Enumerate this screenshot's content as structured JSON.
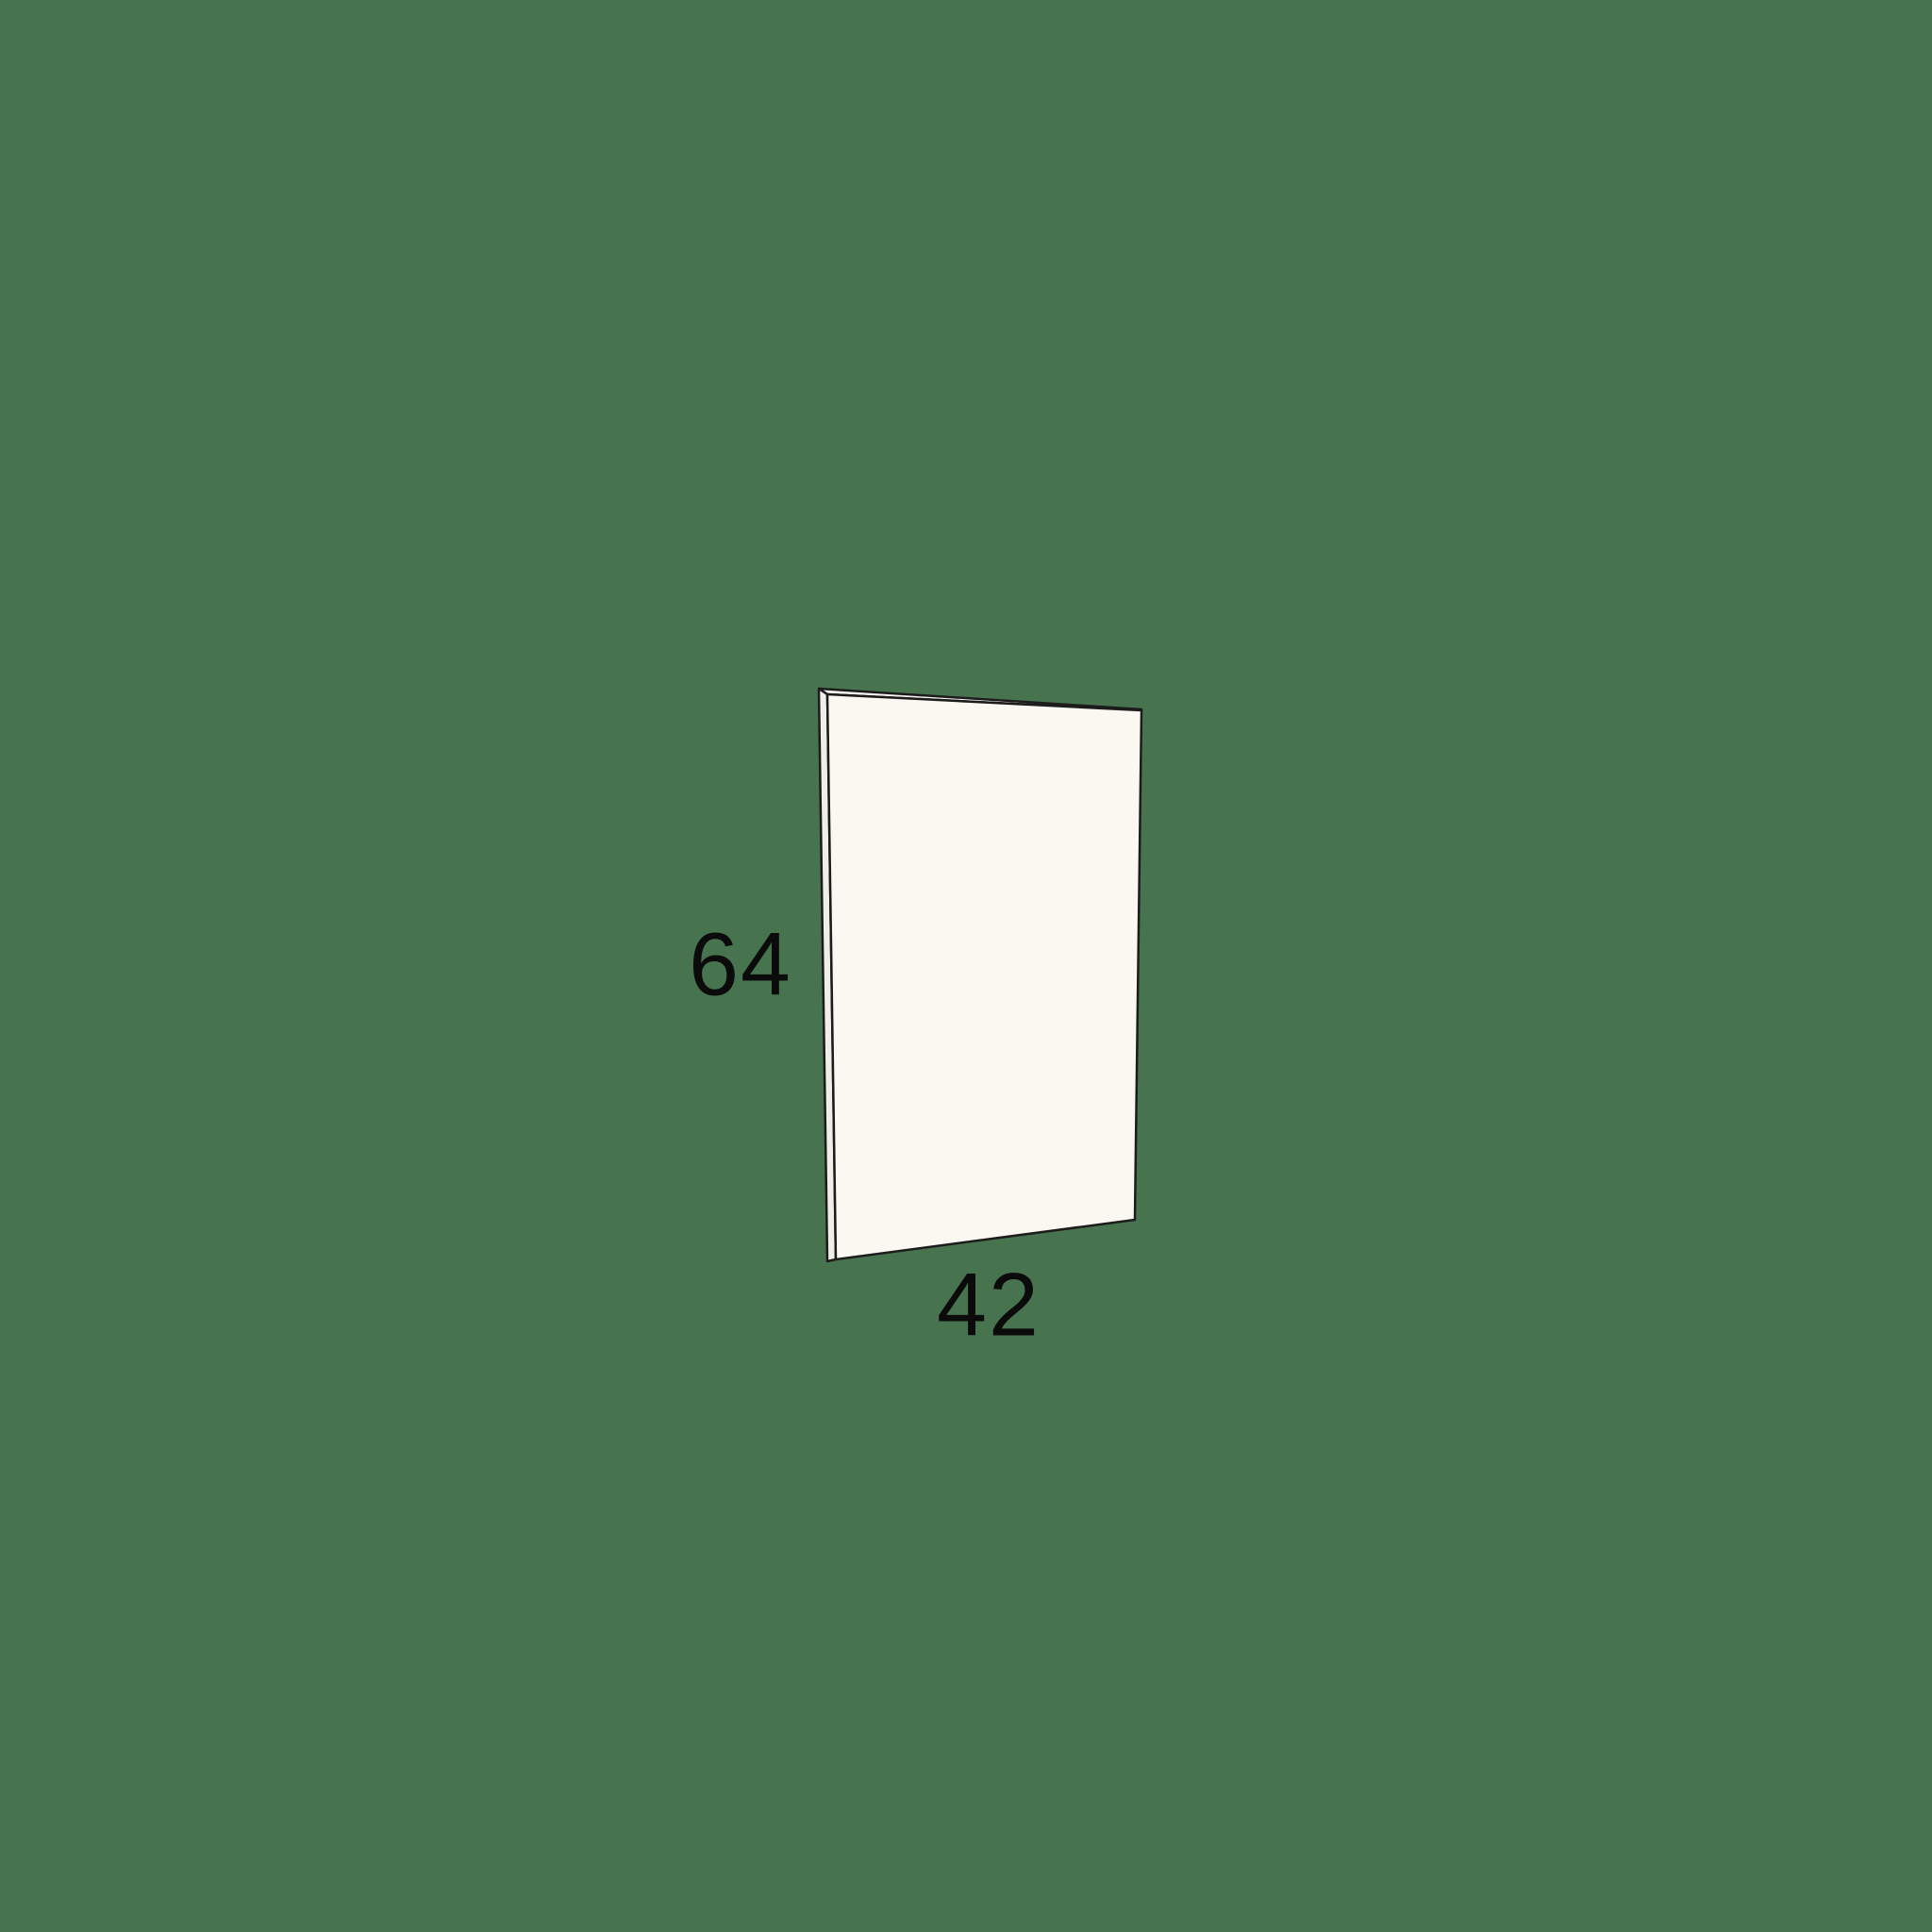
{
  "diagram": {
    "type": "panel-dimension-drawing",
    "height_label": "64",
    "width_label": "42"
  },
  "icons": {
    "panel_illustration": "perspective-panel-drawing"
  },
  "colors": {
    "background": "#48734F",
    "panel_face": "#FBF8F1",
    "panel_edge": "#EFEEE9",
    "panel_top": "#F6F4EE",
    "outline": "#1C1C1C",
    "label_text": "#0B0B0B"
  }
}
